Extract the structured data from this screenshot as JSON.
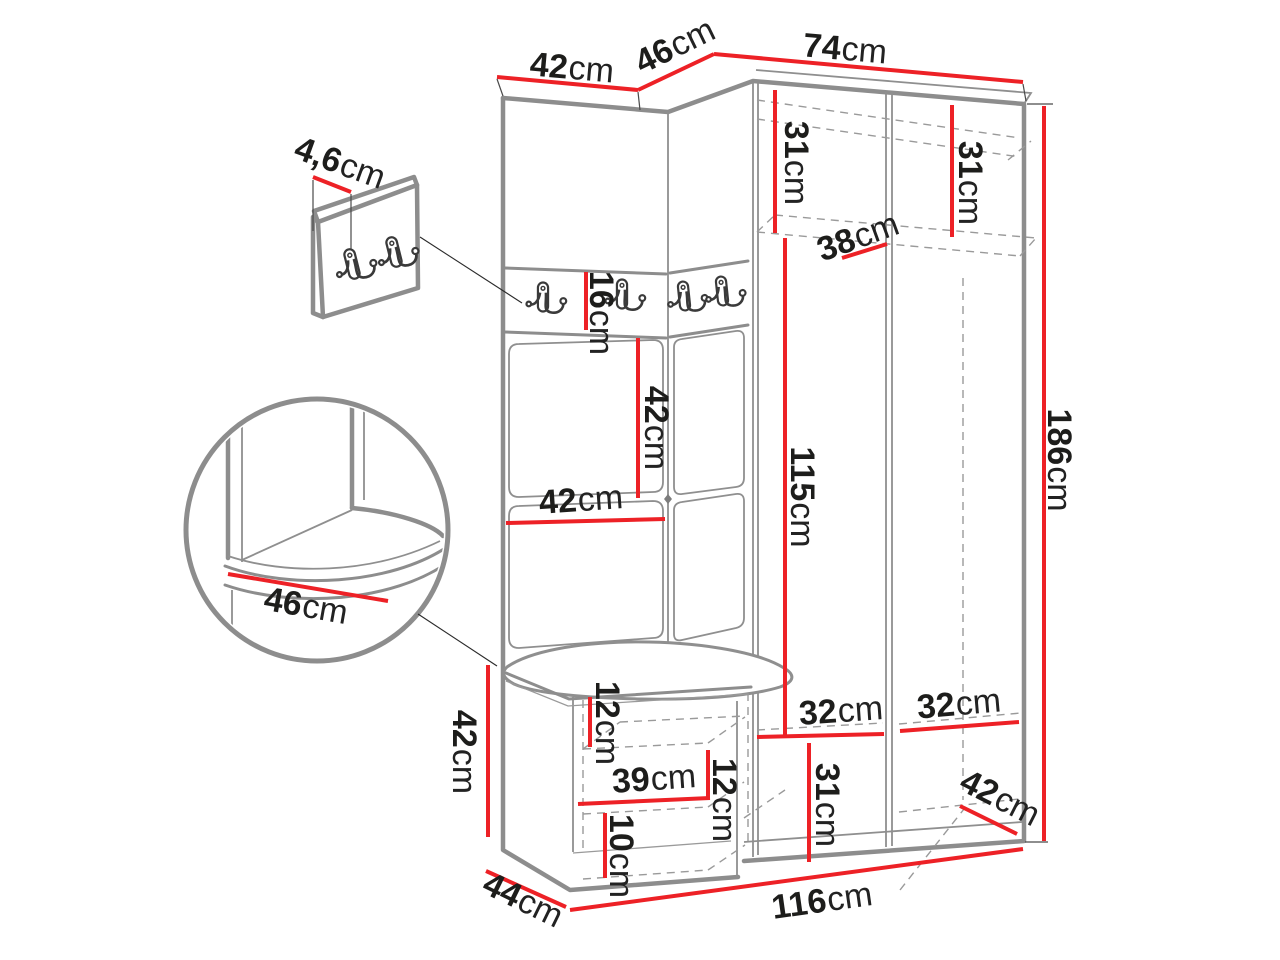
{
  "colors": {
    "dimension_red": "#ed2126",
    "outline_gray": "#8d8d8d",
    "label_text": "#1d1d1b"
  },
  "labels": {
    "top_42": {
      "v": "42",
      "u": "cm"
    },
    "top_46": {
      "v": "46",
      "u": "cm"
    },
    "top_74": {
      "v": "74",
      "u": "cm"
    },
    "thickness_4_6": {
      "v": "4,6",
      "u": "cm"
    },
    "strip_16": {
      "v": "16",
      "u": "cm"
    },
    "panel_42_v": {
      "v": "42",
      "u": "cm"
    },
    "panel_42_h": {
      "v": "42",
      "u": "cm"
    },
    "shelf_31_l": {
      "v": "31",
      "u": "cm"
    },
    "shelf_31_r": {
      "v": "31",
      "u": "cm"
    },
    "shelf_38": {
      "v": "38",
      "u": "cm"
    },
    "inner_115": {
      "v": "115",
      "u": "cm"
    },
    "height_186": {
      "v": "186",
      "u": "cm"
    },
    "bench_42": {
      "v": "42",
      "u": "cm"
    },
    "bench_12_top": {
      "v": "12",
      "u": "cm"
    },
    "bench_39": {
      "v": "39",
      "u": "cm"
    },
    "bench_12_right": {
      "v": "12",
      "u": "cm"
    },
    "bench_10": {
      "v": "10",
      "u": "cm"
    },
    "depth_44": {
      "v": "44",
      "u": "cm"
    },
    "width_116": {
      "v": "116",
      "u": "cm"
    },
    "bottom_32_l": {
      "v": "32",
      "u": "cm"
    },
    "bottom_32_r": {
      "v": "32",
      "u": "cm"
    },
    "bottom_31": {
      "v": "31",
      "u": "cm"
    },
    "depth_42": {
      "v": "42",
      "u": "cm"
    },
    "seat_46": {
      "v": "46",
      "u": "cm"
    }
  }
}
